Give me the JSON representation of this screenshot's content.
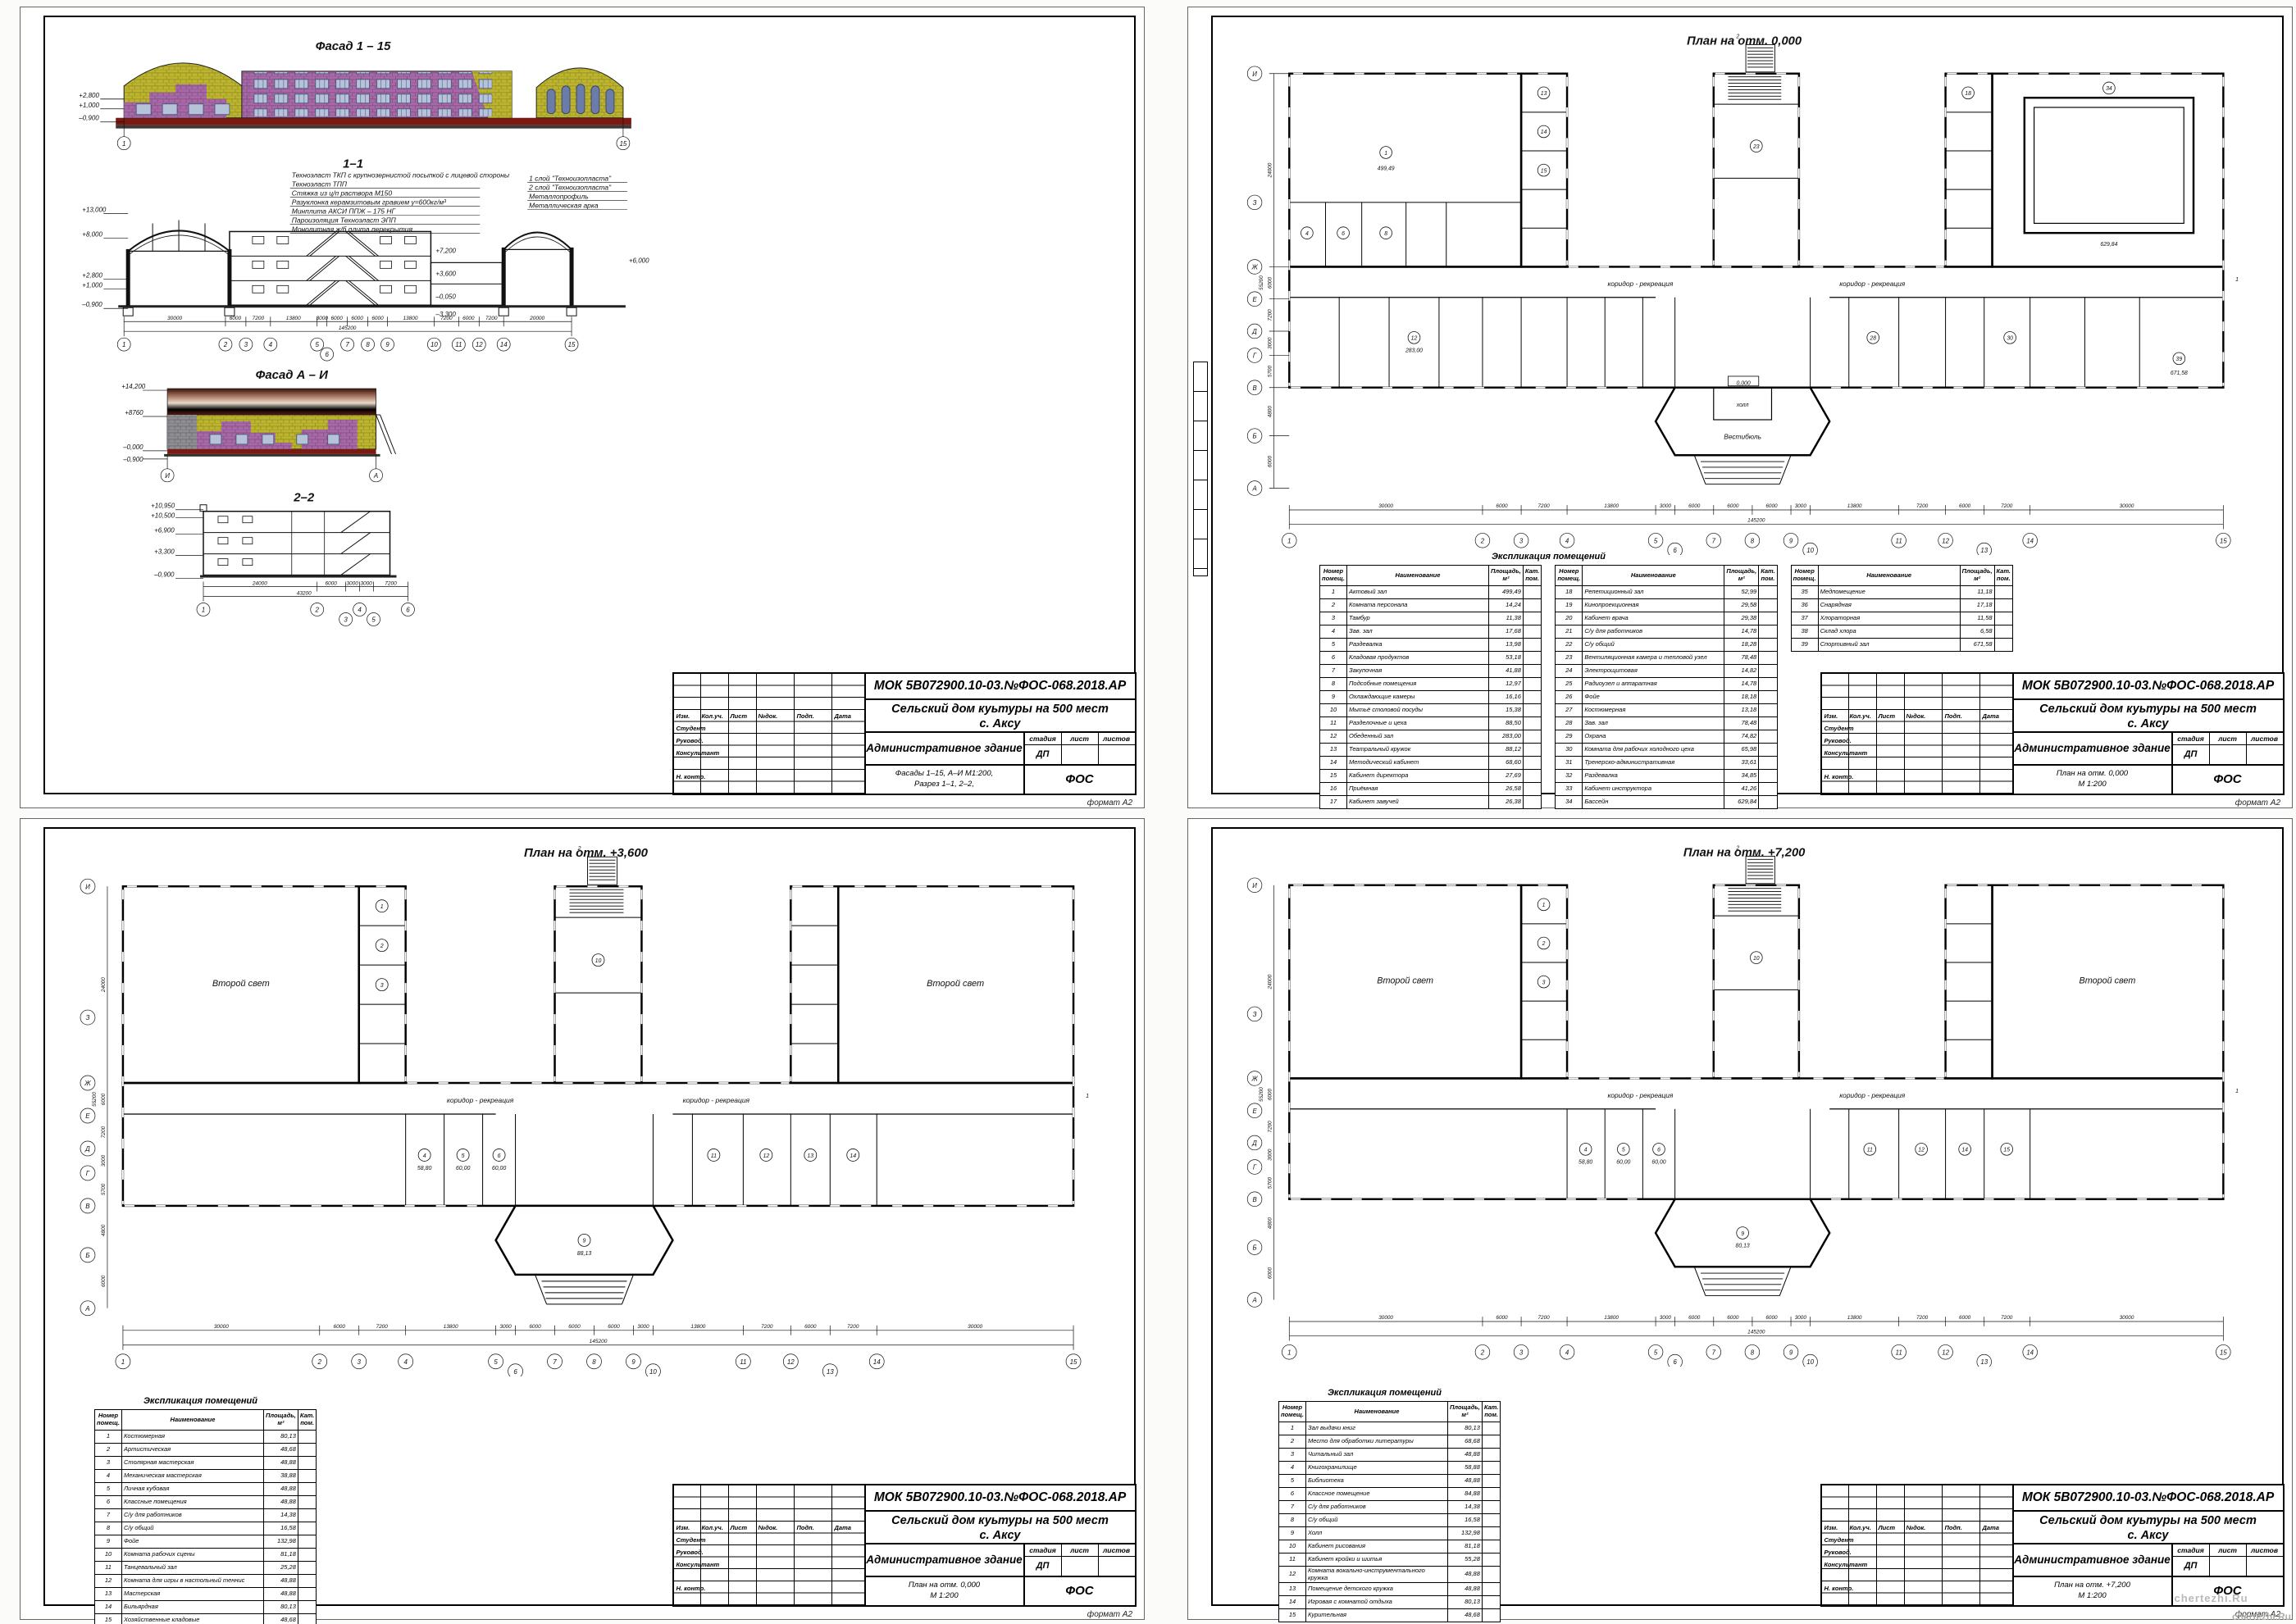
{
  "watermark": "chertezhi.Ru",
  "format_label": "формат А2",
  "titleblock": {
    "code": "МОК 5В072900.10-03.№ФОС-068.2018.АР",
    "project_line1": "Сельский дом куьтуры на 500 мест",
    "project_line2": "с. Аксу",
    "object": "Административное здание",
    "stage_label": "стадия",
    "list_label": "лист",
    "lists_label": "листов",
    "stage": "ДП",
    "org": "ФОС",
    "col_labels": [
      "Изм.",
      "Кол.уч.",
      "Лист",
      "№док.",
      "Подп.",
      "Дата"
    ],
    "row_labels": [
      "Студент",
      "Руковод.",
      "Консультант",
      "Н. контр."
    ]
  },
  "table_headers": {
    "num": "Номер помещ.",
    "name": "Наименование",
    "area": "Площадь, м²",
    "cat": "Кат. пом."
  },
  "schedule_title": "Экспликация помещений",
  "sheet1": {
    "facade_title": "Фасад 1 – 15",
    "section1_title": "1–1",
    "facade2_title": "Фасад А – И",
    "section2_title": "2–2",
    "doc_line": "Фасады 1–15, А–И М1:200,",
    "doc_line2": "Разрез 1–1, 2–2,",
    "roof_spec": [
      "Техноэласт ТКП с крупнозернистой посыпкой с лицевой стороны",
      "Техноэласт ТПП",
      "Стяжка из ц/п раствора М150",
      "Разуклонка керамзитовым гравием γ=600кг/м³",
      "Минплита АКСИ ППЖ – 175 НГ",
      "Пароизоляция Техноэласт ЭПП",
      "Монолитная ж/б плита перекрытия"
    ],
    "arch_spec": [
      "1 слой \"Техноизопласта\"",
      "2 слой \"Техноизопласта\"",
      "Металлопрофиль",
      "Металлическая арка"
    ],
    "facade_marks": [
      "+2,800",
      "+1,000",
      "–0,900"
    ],
    "facade_axes": [
      "1",
      "15"
    ],
    "sec1_marks_left": [
      "+13,000",
      "+8,000",
      "+2,800",
      "+1,000",
      "–0,900"
    ],
    "sec1_marks_mid": [
      "+7,200",
      "+3,600",
      "–0,050",
      "–3,300"
    ],
    "sec1_mark_right": "+6,000",
    "sec1_dims": [
      "30000",
      "6000",
      "7200",
      "13800",
      "3000",
      "6000",
      "6000",
      "6000",
      "13800",
      "7200",
      "6000",
      "7200",
      "20000"
    ],
    "sec1_total": "145200",
    "sec1_axes": [
      "1",
      "2",
      "3",
      "4",
      "5",
      "6",
      "7",
      "8",
      "9",
      "10",
      "11",
      "12",
      "14",
      "15"
    ],
    "f2_marks": [
      "+14,200",
      "+8760",
      "–0,000",
      "–0,900"
    ],
    "f2_axes": [
      "И",
      "А"
    ],
    "sec2_marks": [
      "+10,950",
      "+10,500",
      "+6,900",
      "+3,300",
      "–0,900"
    ],
    "sec2_dims": [
      "24000",
      "6000",
      "3000",
      "3000",
      "7200"
    ],
    "sec2_total": "43200",
    "sec2_axes": [
      "1",
      "2",
      "3",
      "4",
      "5",
      "6"
    ]
  },
  "plan_common": {
    "dims": [
      "30000",
      "6000",
      "7200",
      "13800",
      "3000",
      "6000",
      "6000",
      "6000",
      "3000",
      "13800",
      "7200",
      "6000",
      "7200",
      "30000"
    ],
    "total": "145200",
    "vdims": [
      "24000",
      "6000",
      "7200",
      "3000",
      "5700",
      "4800",
      "6000"
    ],
    "vtotal": "55200",
    "axis_numbers": [
      "1",
      "2",
      "3",
      "4",
      "5",
      "6",
      "7",
      "8",
      "9",
      "10",
      "11",
      "12",
      "13",
      "14",
      "15"
    ],
    "axis_letters": [
      "И",
      "З",
      "Ж",
      "Е",
      "Д",
      "Г",
      "В",
      "Б",
      "А"
    ],
    "corridor_label": "коридор - рекреация",
    "vestibule_label": "Вестибюль",
    "hall_label": "холл",
    "zero_mark": "0,000",
    "sec_flag_1": "1",
    "sec_flag_2": "2"
  },
  "sheet2": {
    "plan_title": "План на отм. 0,000",
    "doc_line": "План на отм. 0,000",
    "doc_scale": "М 1:200",
    "areas": {
      "hall_left": "499,49",
      "dining": "283,00",
      "pool": "629,84",
      "gym": "671,58"
    },
    "room_marks": [
      "1",
      "4",
      "6",
      "8",
      "12",
      "13",
      "14",
      "15",
      "18",
      "23",
      "28",
      "30",
      "34",
      "39"
    ],
    "tables": {
      "a": [
        {
          "n": "1",
          "name": "Актовый зал",
          "area": "499,49"
        },
        {
          "n": "2",
          "name": "Комната персонала",
          "area": "14,24"
        },
        {
          "n": "3",
          "name": "Тамбур",
          "area": "11,38"
        },
        {
          "n": "4",
          "name": "Зав. зал",
          "area": "17,68"
        },
        {
          "n": "5",
          "name": "Раздевалка",
          "area": "13,98"
        },
        {
          "n": "6",
          "name": "Кладовая продуктов",
          "area": "53,18"
        },
        {
          "n": "7",
          "name": "Закупочная",
          "area": "41,88"
        },
        {
          "n": "8",
          "name": "Подсобные помещения",
          "area": "12,97"
        },
        {
          "n": "9",
          "name": "Охлаждающие камеры",
          "area": "16,16"
        },
        {
          "n": "10",
          "name": "Мытьё столовой посуды",
          "area": "15,38"
        },
        {
          "n": "11",
          "name": "Разделочные и цеха",
          "area": "88,50"
        },
        {
          "n": "12",
          "name": "Обеденный зал",
          "area": "283,00"
        },
        {
          "n": "13",
          "name": "Театральный кружок",
          "area": "88,12"
        },
        {
          "n": "14",
          "name": "Методический кабинет",
          "area": "68,60"
        },
        {
          "n": "15",
          "name": "Кабинет директора",
          "area": "27,69"
        },
        {
          "n": "16",
          "name": "Приёмная",
          "area": "26,58"
        },
        {
          "n": "17",
          "name": "Кабинет завучей",
          "area": "26,38"
        }
      ],
      "b": [
        {
          "n": "18",
          "name": "Репетиционный зал",
          "area": "52,99"
        },
        {
          "n": "19",
          "name": "Кинопроекционная",
          "area": "29,58"
        },
        {
          "n": "20",
          "name": "Кабинет врача",
          "area": "29,38"
        },
        {
          "n": "21",
          "name": "С/у для работников",
          "area": "14,78"
        },
        {
          "n": "22",
          "name": "С/у общий",
          "area": "18,28"
        },
        {
          "n": "23",
          "name": "Вентиляционная камера и тепловой узел",
          "area": "78,48"
        },
        {
          "n": "24",
          "name": "Электрощитовая",
          "area": "14,82"
        },
        {
          "n": "25",
          "name": "Радиоузел и аппаратная",
          "area": "14,78"
        },
        {
          "n": "26",
          "name": "Фойе",
          "area": "18,18"
        },
        {
          "n": "27",
          "name": "Костюмерная",
          "area": "13,18"
        },
        {
          "n": "28",
          "name": "Зав. зал",
          "area": "78,48"
        },
        {
          "n": "29",
          "name": "Охрана",
          "area": "74,82"
        },
        {
          "n": "30",
          "name": "Комната для рабочих холодного цеха",
          "area": "65,98"
        },
        {
          "n": "31",
          "name": "Тренерско-административная",
          "area": "33,61"
        },
        {
          "n": "32",
          "name": "Раздевалка",
          "area": "34,85"
        },
        {
          "n": "33",
          "name": "Кабинет инструктора",
          "area": "41,26"
        },
        {
          "n": "34",
          "name": "Бассейн",
          "area": "629,84"
        }
      ],
      "c": [
        {
          "n": "35",
          "name": "Медпомещение",
          "area": "11,18"
        },
        {
          "n": "36",
          "name": "Снарядная",
          "area": "17,18"
        },
        {
          "n": "37",
          "name": "Хлораторная",
          "area": "11,58"
        },
        {
          "n": "38",
          "name": "Склад хлора",
          "area": "6,58"
        },
        {
          "n": "39",
          "name": "Спортивный зал",
          "area": "671,58"
        }
      ]
    }
  },
  "sheet3": {
    "plan_title": "План на отм. +3,600",
    "doc_line": "План на отм. 0,000",
    "doc_scale": "М 1:200",
    "void_label": "Второй свет",
    "room_marks": [
      "1",
      "2",
      "3",
      "4",
      "5",
      "6",
      "9",
      "10",
      "11",
      "12",
      "13",
      "14"
    ],
    "areas": [
      "58,80",
      "60,00",
      "60,00",
      "88,13"
    ],
    "table": [
      {
        "n": "1",
        "name": "Костюмерная",
        "area": "80,13"
      },
      {
        "n": "2",
        "name": "Артистическая",
        "area": "48,68"
      },
      {
        "n": "3",
        "name": "Столярная мастерская",
        "area": "48,88"
      },
      {
        "n": "4",
        "name": "Механическая мастерская",
        "area": "38,88"
      },
      {
        "n": "5",
        "name": "Личная кубовая",
        "area": "48,88"
      },
      {
        "n": "6",
        "name": "Классные помещения",
        "area": "48,88"
      },
      {
        "n": "7",
        "name": "С/у для работников",
        "area": "14,38"
      },
      {
        "n": "8",
        "name": "С/у общий",
        "area": "16,58"
      },
      {
        "n": "9",
        "name": "Фойе",
        "area": "132,98"
      },
      {
        "n": "10",
        "name": "Комната рабочих сцены",
        "area": "81,18"
      },
      {
        "n": "11",
        "name": "Танцевальный зал",
        "area": "25,28"
      },
      {
        "n": "12",
        "name": "Комната для игры в настольный теннис",
        "area": "48,88"
      },
      {
        "n": "13",
        "name": "Мастерская",
        "area": "48,88"
      },
      {
        "n": "14",
        "name": "Бильярдная",
        "area": "80,13"
      },
      {
        "n": "15",
        "name": "Хозяйственные кладовые",
        "area": "48,68"
      },
      {
        "n": "16",
        "name": "Хозяйственные кладовые",
        "area": "48,88"
      }
    ]
  },
  "sheet4": {
    "plan_title": "План на отм. +7,200",
    "doc_line": "План на отм. +7,200",
    "doc_scale": "М 1:200",
    "void_label": "Второй свет",
    "room_marks": [
      "1",
      "2",
      "3",
      "4",
      "5",
      "6",
      "9",
      "10",
      "11",
      "12",
      "14",
      "15"
    ],
    "areas": [
      "58,80",
      "60,00",
      "60,00",
      "80,13"
    ],
    "table": [
      {
        "n": "1",
        "name": "Зал выдачи книг",
        "area": "80,13"
      },
      {
        "n": "2",
        "name": "Место для обработки литературы",
        "area": "68,68"
      },
      {
        "n": "3",
        "name": "Читальный зал",
        "area": "48,88"
      },
      {
        "n": "4",
        "name": "Книгохранилище",
        "area": "58,88"
      },
      {
        "n": "5",
        "name": "Библиотека",
        "area": "48,88"
      },
      {
        "n": "6",
        "name": "Классное помещение",
        "area": "84,88"
      },
      {
        "n": "7",
        "name": "С/у для работников",
        "area": "14,38"
      },
      {
        "n": "8",
        "name": "С/у общий",
        "area": "16,58"
      },
      {
        "n": "9",
        "name": "Холл",
        "area": "132,98"
      },
      {
        "n": "10",
        "name": "Кабинет рисования",
        "area": "81,18"
      },
      {
        "n": "11",
        "name": "Кабинет кройки и шитья",
        "area": "55,28"
      },
      {
        "n": "12",
        "name": "Комната вокально-инструментального кружка",
        "area": "48,88"
      },
      {
        "n": "13",
        "name": "Помещение детского кружка",
        "area": "48,88"
      },
      {
        "n": "14",
        "name": "Игровая с комнатой отдыха",
        "area": "80,13"
      },
      {
        "n": "15",
        "name": "Курительная",
        "area": "48,68"
      }
    ]
  }
}
